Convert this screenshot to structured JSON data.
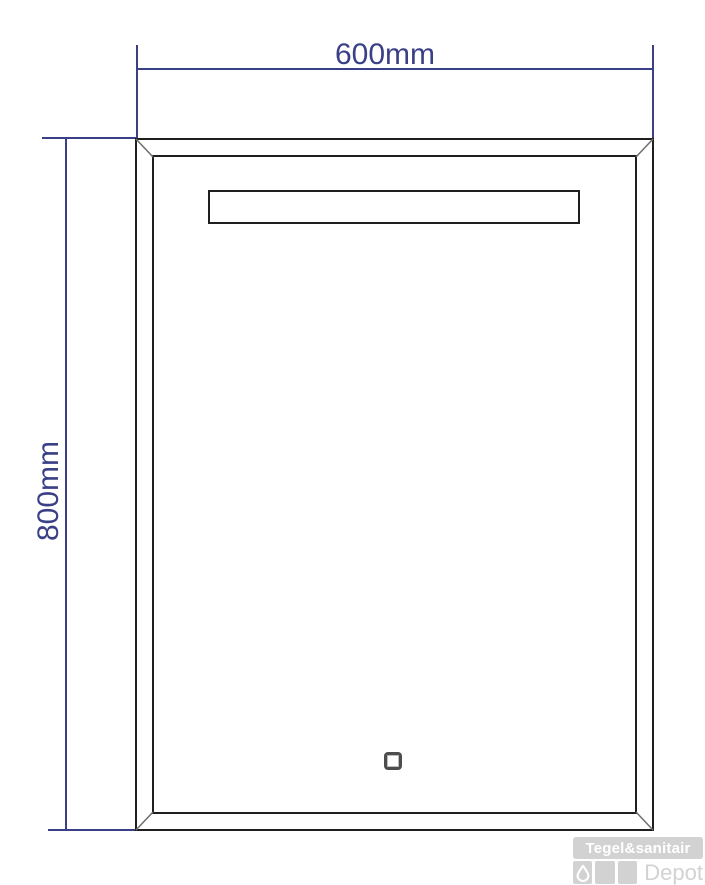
{
  "drawing": {
    "type": "technical-drawing",
    "width_dimension_label": "600mm",
    "height_dimension_label": "800mm",
    "elements": {
      "frame": "mirror-outline-with-beveled-corners",
      "led_strip": "horizontal-light-strip-top",
      "touch_button": "touch-sensor-square-bottom-center"
    }
  },
  "logo": {
    "brand_top": "Tegel&sanitair",
    "brand_bottom": "Depot",
    "icon": "water-drop-icon"
  },
  "colors": {
    "background": "#ffffff",
    "dimension_line": "#3a4086",
    "frame_line": "#1f1f1f",
    "bevel_line": "#6e6e6e",
    "logo_gray": "#d2d2d2",
    "logo_text": "#ffffff"
  }
}
